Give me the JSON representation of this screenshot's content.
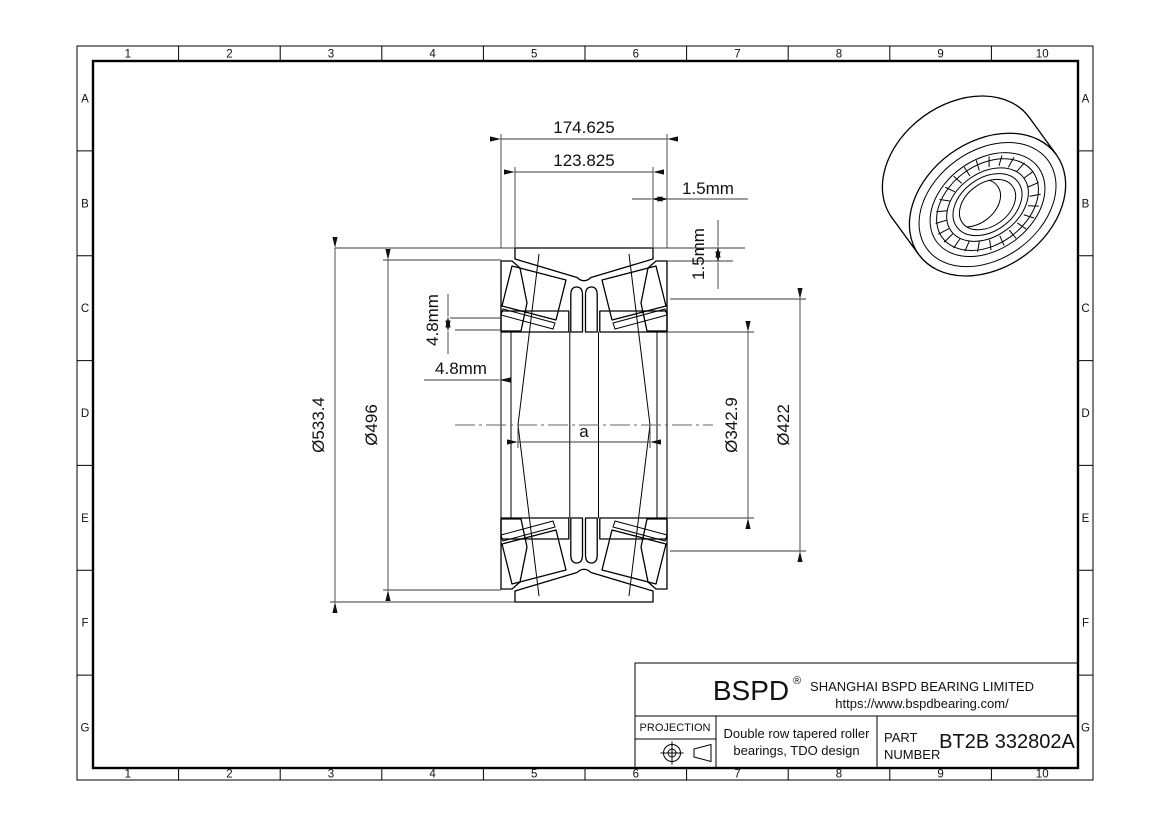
{
  "drawing": {
    "grid": {
      "columns": [
        "1",
        "2",
        "3",
        "4",
        "5",
        "6",
        "7",
        "8",
        "9",
        "10"
      ],
      "rows": [
        "A",
        "B",
        "C",
        "D",
        "E",
        "F",
        "G"
      ]
    },
    "dimensions": {
      "overall_width": "174.625",
      "cup_width": "123.825",
      "offset_top": "1.5mm",
      "offset_side": "1.5mm",
      "standout_vertical": "4.8mm",
      "standout_horizontal": "4.8mm",
      "outer_diameter": "Ø533.4",
      "flange_diameter": "Ø496",
      "bore_diameter": "Ø342.9",
      "rib_diameter": "Ø422",
      "pressure_center": "a"
    },
    "title_block": {
      "logo": "BSPD",
      "logo_reg": "®",
      "company": "SHANGHAI BSPD BEARING LIMITED",
      "website": "https://www.bspdbearing.com/",
      "projection_label": "PROJECTION",
      "description_line1": "Double row tapered roller",
      "description_line2": "bearings, TDO design",
      "part_label_line1": "PART",
      "part_label_line2": "NUMBER",
      "part_number": "BT2B 332802A"
    }
  }
}
